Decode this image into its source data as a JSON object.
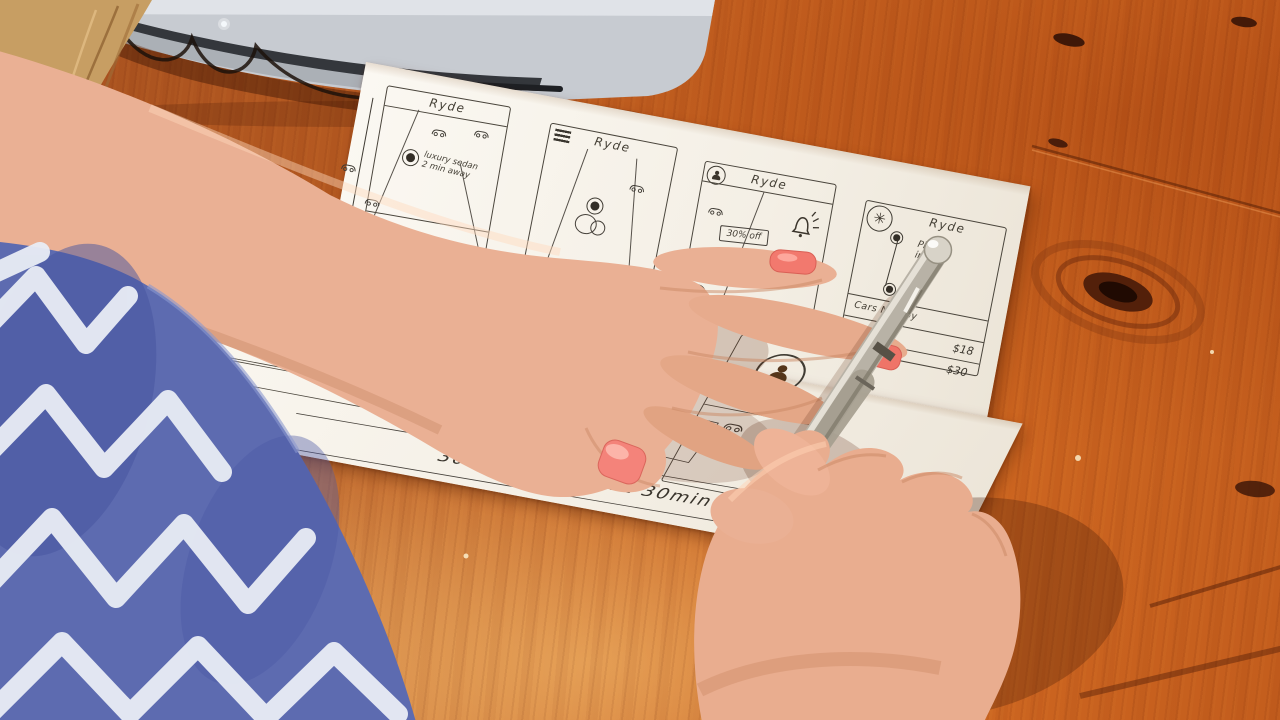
{
  "colors": {
    "wood_mid": "#c66120",
    "wood_light": "#e8a55c",
    "wood_dark": "#8f3c12",
    "paper": "#f6f2ea",
    "ink": "#3f3b34",
    "laptop_body": "#c7cbd1",
    "laptop_hinge": "#34373c",
    "skin": "#eab094",
    "sleeve_blue": "#5d6bb0",
    "sleeve_white": "#e9edf5",
    "nail_coral": "#f2796e",
    "pen_silver": "#b8b2a6",
    "hair_blonde": "#c79e63"
  },
  "sheet_top": {
    "screen_map_note": {
      "title": "Ryde",
      "note_line1": "luxury sedan",
      "note_line2": "2 min away"
    },
    "screen_map_menu": {
      "title": "Ryde"
    },
    "screen_promo": {
      "title": "Ryde",
      "badge": "30% off"
    },
    "screen_prices": {
      "title": "Ryde",
      "pickup_line1": "Pickup",
      "pickup_line2": "in",
      "list_header": "Cars Nearby",
      "price_row1": "$18",
      "price_row2": "$30"
    }
  },
  "sheet_bottom": {
    "screen_map": {
      "note_line1": "luxury",
      "note_line2": "sedan",
      "note_line3": "2min.",
      "note_line4": "away",
      "time_note": "6am / 4pm"
    },
    "screen_places": {
      "item_home": "Home",
      "item_work": "Work",
      "item_safeway": "Safeway",
      "item_safeway_sub": "San Francisco, CA"
    },
    "promo_banner": "30% OFF for next 30min",
    "screen_tiers": {
      "tier1": "Economy",
      "tier2": "Luxury",
      "tier3": "XL"
    },
    "screen_seats": {
      "seats_label": "4 seats"
    }
  }
}
